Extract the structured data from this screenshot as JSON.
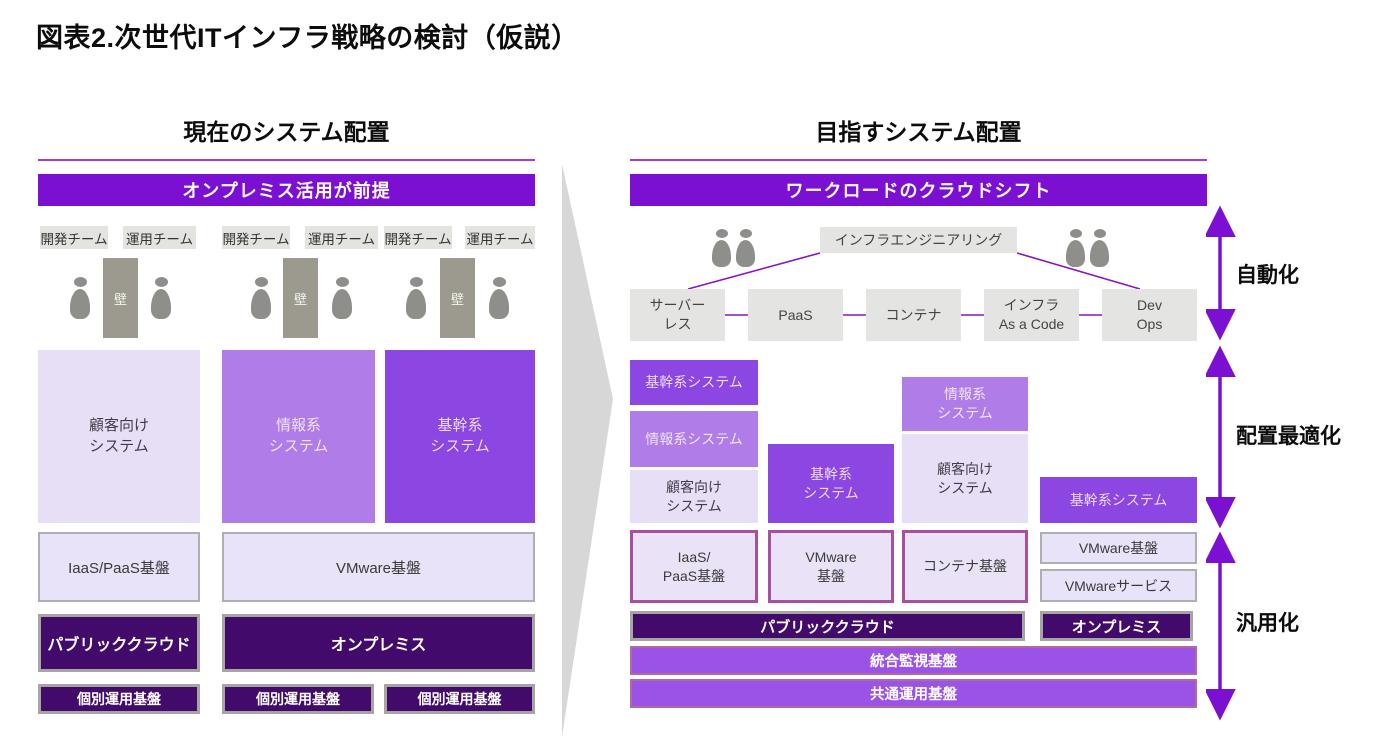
{
  "title": "図表2.次世代ITインフラ戦略の検討（仮説）",
  "left": {
    "heading": "現在のシステム配置",
    "banner": "オンプレミス活用が前提",
    "teams": [
      "開発チーム",
      "運用チーム",
      "開発チーム",
      "運用チーム",
      "開発チーム",
      "運用チーム"
    ],
    "wall": "壁",
    "systems": [
      "顧客向け\nシステム",
      "情報系\nシステム",
      "基幹系\nシステム"
    ],
    "platforms": [
      "IaaS/PaaS基盤",
      "VMware基盤"
    ],
    "clouds": [
      "パブリッククラウド",
      "オンプレミス"
    ],
    "ops": [
      "個別運用基盤",
      "個別運用基盤",
      "個別運用基盤"
    ]
  },
  "right": {
    "heading": "目指すシステム配置",
    "banner": "ワークロードのクラウドシフト",
    "engineering": "インフラエンジニアリング",
    "tech": [
      "サーバー\nレス",
      "PaaS",
      "コンテナ",
      "インフラ\nAs a Code",
      "Dev\nOps"
    ],
    "systems": {
      "a1": "基幹系システム",
      "a2": "情報系システム",
      "a3": "顧客向け\nシステム",
      "b1": "基幹系\nシステム",
      "c1": "情報系\nシステム",
      "c2": "顧客向け\nシステム",
      "d1": "基幹系システム"
    },
    "platforms_cloud": [
      "IaaS/\nPaaS基盤",
      "VMware\n基盤",
      "コンテナ基盤"
    ],
    "platforms_onprem": [
      "VMware基盤",
      "VMwareサービス"
    ],
    "clouds": [
      "パブリッククラウド",
      "オンプレミス"
    ],
    "bands": [
      "統合監視基盤",
      "共通運用基盤"
    ]
  },
  "axis": [
    "自動化",
    "配置最適化",
    "汎用化"
  ],
  "colors": {
    "banner_purple": "#7b10d2",
    "dark_indigo": "#410a6b",
    "strong_purple": "#8c46e2",
    "medium_purple": "#b07de8",
    "light_lavender": "#e6dff6",
    "band_purple": "#9a53e6",
    "magenta_border": "#a94f9f",
    "gray_box": "#e4e4e2",
    "wall_gray": "#9c9a8e",
    "arrow_purple": "#7b10d2"
  }
}
